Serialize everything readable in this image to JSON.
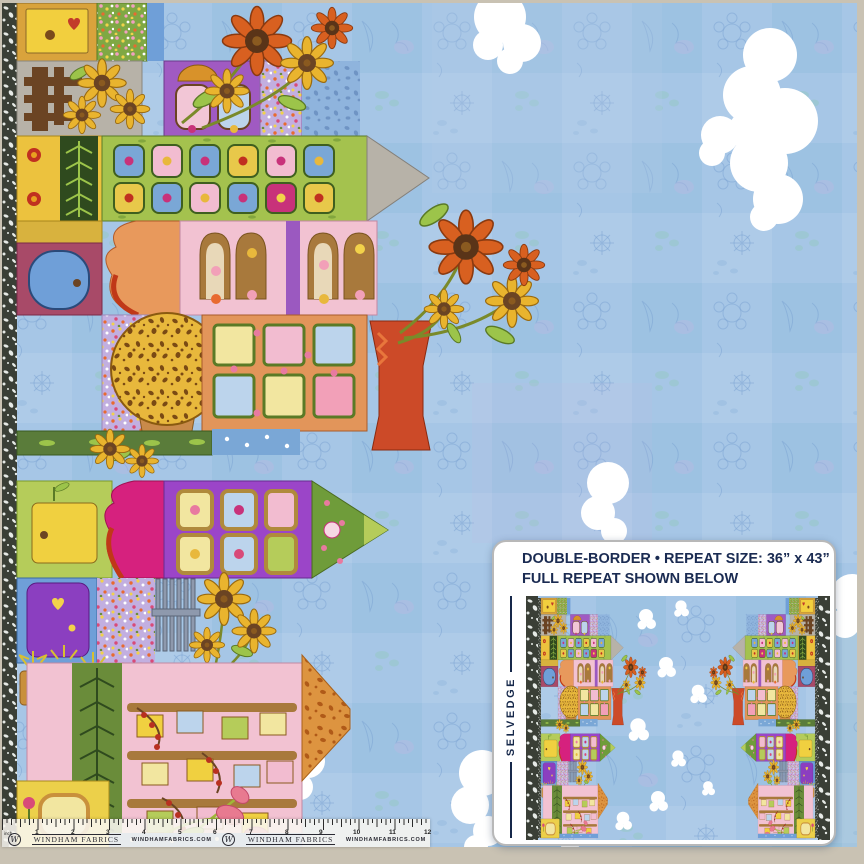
{
  "photo": {
    "background_color": "#c9c2b3",
    "sky_color": "#a6c6e6",
    "cloud_color": "#ffffff",
    "selvedge_strip_color": "#3a3f36",
    "palette": [
      "#d9a33c",
      "#f2cf3e",
      "#a05ac2",
      "#f2c2d2",
      "#cc4a28",
      "#b5cc5a",
      "#d6217e",
      "#9b45c8",
      "#6f9fd8",
      "#e2955a",
      "#e9b42e",
      "#6b4423",
      "#7fa844",
      "#dd9440"
    ]
  },
  "info_panel": {
    "line1": "DOUBLE-BORDER • REPEAT SIZE: 36” x 43”",
    "line2": "FULL REPEAT SHOWN BELOW",
    "selvedge_label": "SELVEDGE",
    "text_color": "#1a2b52"
  },
  "ruler": {
    "unit_label": "inch",
    "numbers": [
      "1",
      "2",
      "3",
      "4",
      "5",
      "6",
      "7",
      "8",
      "9",
      "10",
      "11",
      "12"
    ],
    "monogram": "W",
    "brand": "WINDHAM FABRICS",
    "website": "WINDHAMFABRICS.COM"
  }
}
